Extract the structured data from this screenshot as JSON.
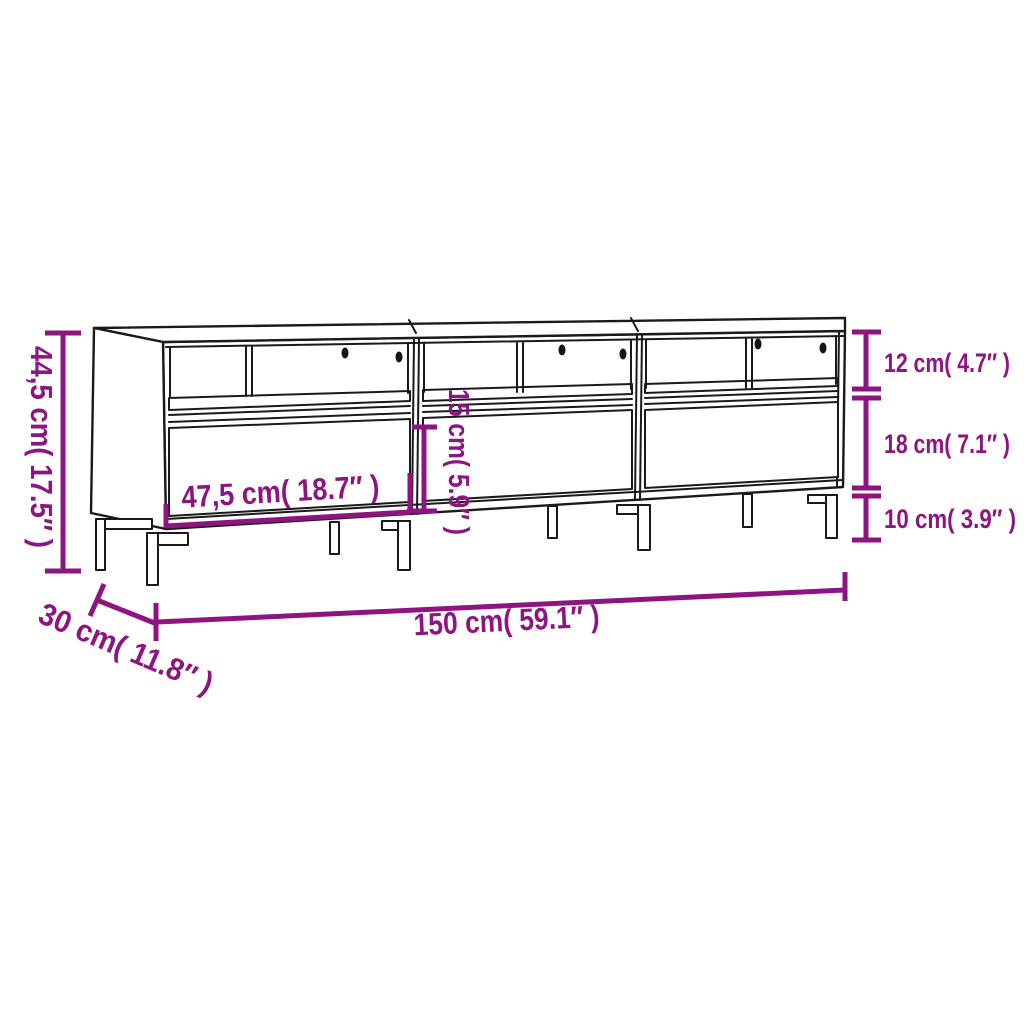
{
  "dimension_labels": {
    "total_height": "44,5 cm( 17.5″ )",
    "compartment_height": "12 cm( 4.7″ )",
    "drawer_front_height": "18 cm( 7.1″ )",
    "leg_height": "10 cm( 3.9″ )",
    "drawer_inner_height": "15 cm( 5.9″ )",
    "drawer_width": "47,5 cm( 18.7″ )",
    "total_width": "150 cm( 59.1″ )",
    "total_depth": "30 cm( 11.8″ )"
  },
  "colors": {
    "dimension_accent": "#8E1482",
    "line_art": "#1a1a1a",
    "background": "#ffffff"
  }
}
